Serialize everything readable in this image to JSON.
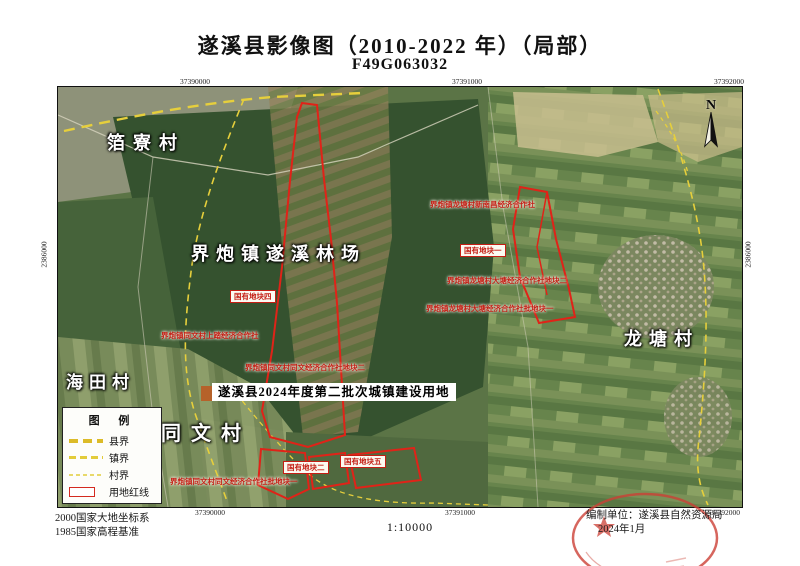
{
  "title": "遂溪县影像图（2010-2022 年）（局部）",
  "sheet_code": "F49G063032",
  "map": {
    "north_label": "N",
    "grid": {
      "top": [
        "37390000",
        "37391000",
        "37392000"
      ],
      "bottom": [
        "37390000",
        "37391000",
        "37392000"
      ],
      "left": "2386000",
      "right": "2386000"
    },
    "place_labels": [
      {
        "text": "箔寮村"
      },
      {
        "text": "界炮镇遂溪林场"
      },
      {
        "text": "龙塘村"
      },
      {
        "text": "海田村"
      },
      {
        "text": "同文村"
      }
    ],
    "parcel_labels": [
      {
        "text": "界炮镇龙塘村新南昌经济合作社"
      },
      {
        "text": "界炮镇龙塘村大塘经济合作社地块二"
      },
      {
        "text": "界炮镇龙塘村大塘经济合作社批地块一"
      },
      {
        "text": "界炮镇同文村上踏经济合作社"
      },
      {
        "text": "界炮镇同文村同文经济合作社地块二"
      },
      {
        "text": "界炮镇同文村同文经济合作社批地块一"
      }
    ],
    "state_parcel_labels": [
      {
        "text": "国有地块一"
      },
      {
        "text": "国有地块四"
      },
      {
        "text": "国有地块二"
      },
      {
        "text": "国有地块五"
      }
    ],
    "highlight_label": "遂溪县2024年度第二批次城镇建设用地"
  },
  "legend": {
    "title": "图 例",
    "items": [
      {
        "label": "县界"
      },
      {
        "label": "镇界"
      },
      {
        "label": "村界"
      },
      {
        "label": "用地红线"
      }
    ]
  },
  "footer": {
    "datum_line1": "2000国家大地坐标系",
    "datum_line2": "1985国家高程基准",
    "scale": "1:10000",
    "credit_line1": "编制单位：遂溪县自然资源局",
    "credit_line2": "2024年1月"
  },
  "colors": {
    "redline": "#e02318",
    "boundary_yellow": "#e6cf3c",
    "label_red": "#c41e14"
  }
}
